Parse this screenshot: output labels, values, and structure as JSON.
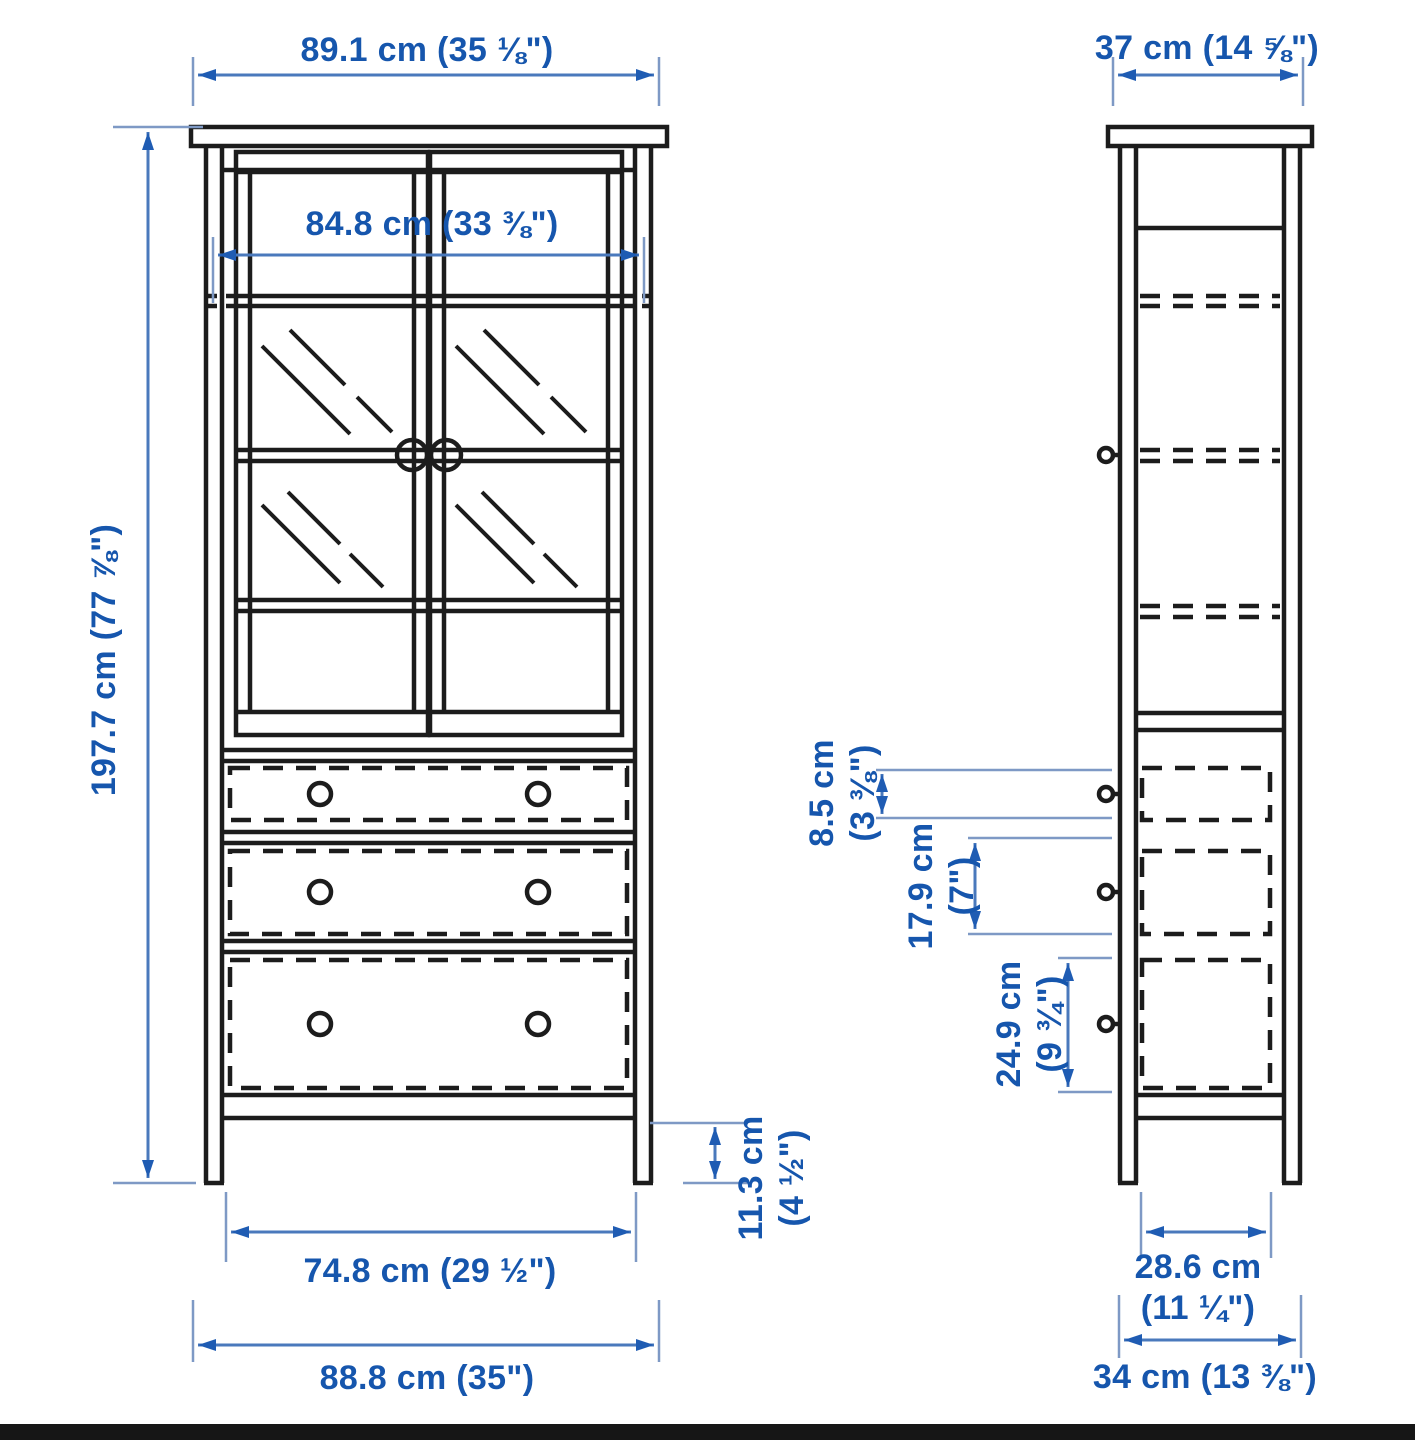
{
  "colors": {
    "label-blue": "#1656ad",
    "dim-line-blue": "#4a79bc",
    "arrowhead-blue": "#1f5cb3",
    "extension-blue": "#7e99c5",
    "drawing-ink": "#1c1c1c",
    "footer-bar": "#161616",
    "background": "#ffffff"
  },
  "views": {
    "front": {
      "name": "front-view",
      "dimensions": {
        "top_width": {
          "text": "89.1 cm (35 ⅛\")"
        },
        "inner_width": {
          "text": "84.8 cm (33 ⅜\")"
        },
        "height": {
          "text": "197.7 cm (77 ⅞\")"
        },
        "plinth_height": {
          "line1": "11.3 cm",
          "line2": "(4 ½\")"
        },
        "drawer_width": {
          "text": "74.8 cm (29 ½\")"
        },
        "base_width": {
          "text": "88.8 cm (35\")"
        }
      }
    },
    "side": {
      "name": "side-view",
      "dimensions": {
        "top_depth": {
          "text": "37 cm (14 ⅝\")"
        },
        "top_drawer_height": {
          "line1": "8.5 cm",
          "line2": "(3 ⅜\")"
        },
        "middle_drawer_height": {
          "line1": "17.9 cm",
          "line2": "(7\")"
        },
        "bottom_drawer_height": {
          "line1": "24.9 cm",
          "line2": "(9 ¾\")"
        },
        "inner_depth": {
          "line1": "28.6 cm",
          "line2": "(11 ¼\")"
        },
        "base_depth": {
          "text": "34 cm (13 ⅜\")"
        }
      }
    }
  }
}
